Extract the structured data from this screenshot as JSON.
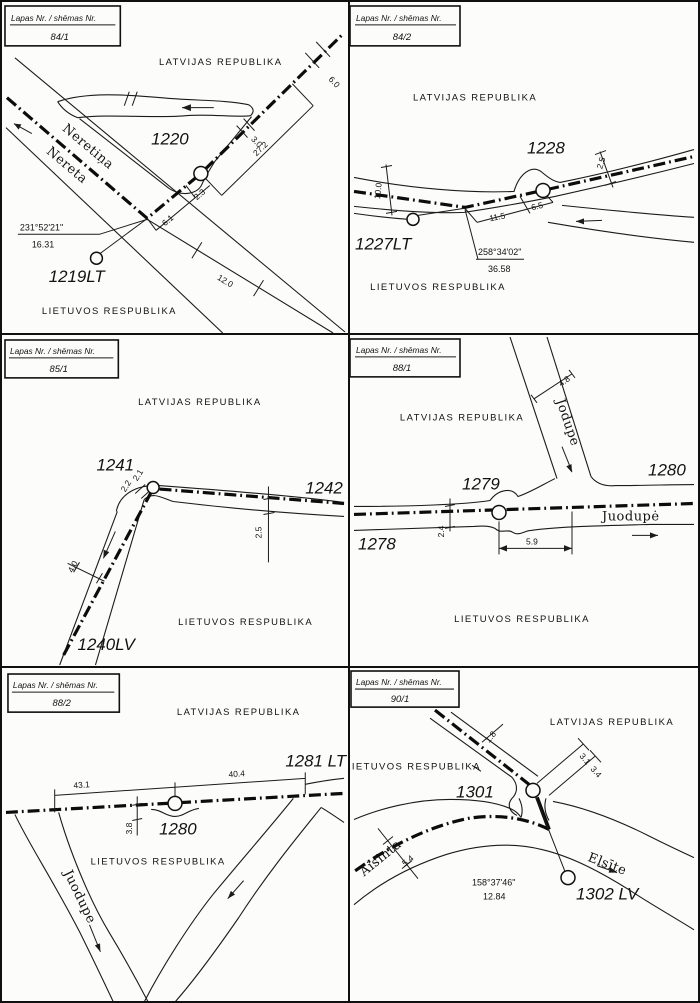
{
  "title_box_label": "Lapas Nr. / shēmas Nr.",
  "panels": [
    {
      "sheet": "84/1",
      "latvia": "LATVIJAS REPUBLIKA",
      "lithuania": "LIETUVOS RESPUBLIKA",
      "points": [
        "1220",
        "1219LT"
      ],
      "rivers": [
        "Neretiņa",
        "Nereta"
      ],
      "azimuth": "231°52'21\"",
      "azimuth_length": "16.31",
      "dims": [
        "6.0",
        "3.0",
        "27.2",
        "2.3",
        "6.1",
        "12.0"
      ]
    },
    {
      "sheet": "84/2",
      "latvia": "LATVIJAS REPUBLIKA",
      "lithuania": "LIETUVOS RESPUBLIKA",
      "points": [
        "1228",
        "1227LT"
      ],
      "azimuth": "258°34'02\"",
      "azimuth_length": "36.58",
      "dims": [
        "10.0",
        "2.5",
        "11.5",
        "6.5"
      ]
    },
    {
      "sheet": "85/1",
      "latvia": "LATVIJAS REPUBLIKA",
      "lithuania": "LIETUVOS RESPUBLIKA",
      "points": [
        "1241",
        "1242",
        "1240LV"
      ],
      "dims": [
        "2.2",
        "2.1",
        "2.5",
        "4.0"
      ]
    },
    {
      "sheet": "88/1",
      "latvia": "LATVIJAS REPUBLIKA",
      "lithuania": "LIETUVOS RESPUBLIKA",
      "points": [
        "1279",
        "1280",
        "1278"
      ],
      "rivers": [
        "Jodupe",
        "Juodupė"
      ],
      "dims": [
        "4.8",
        "2.4",
        "5.9"
      ]
    },
    {
      "sheet": "88/2",
      "latvia": "LATVIJAS REPUBLIKA",
      "lithuania": "LIETUVOS RESPUBLIKA",
      "points": [
        "1281 LT",
        "1280"
      ],
      "rivers": [
        "Juodupe"
      ],
      "dims": [
        "43.1",
        "40.4",
        "3.8"
      ]
    },
    {
      "sheet": "90/1",
      "latvia": "LATVIJAS REPUBLIKA",
      "lithuania": "LIETUVOS RESPUBLIKA",
      "points": [
        "1301",
        "1302 LV"
      ],
      "rivers": [
        "Aisinta",
        "Elsīte"
      ],
      "azimuth": "158°37'46\"",
      "azimuth_length": "12.84",
      "dims": [
        "1.8",
        "3.1",
        "3.4",
        "5.4"
      ]
    }
  ]
}
